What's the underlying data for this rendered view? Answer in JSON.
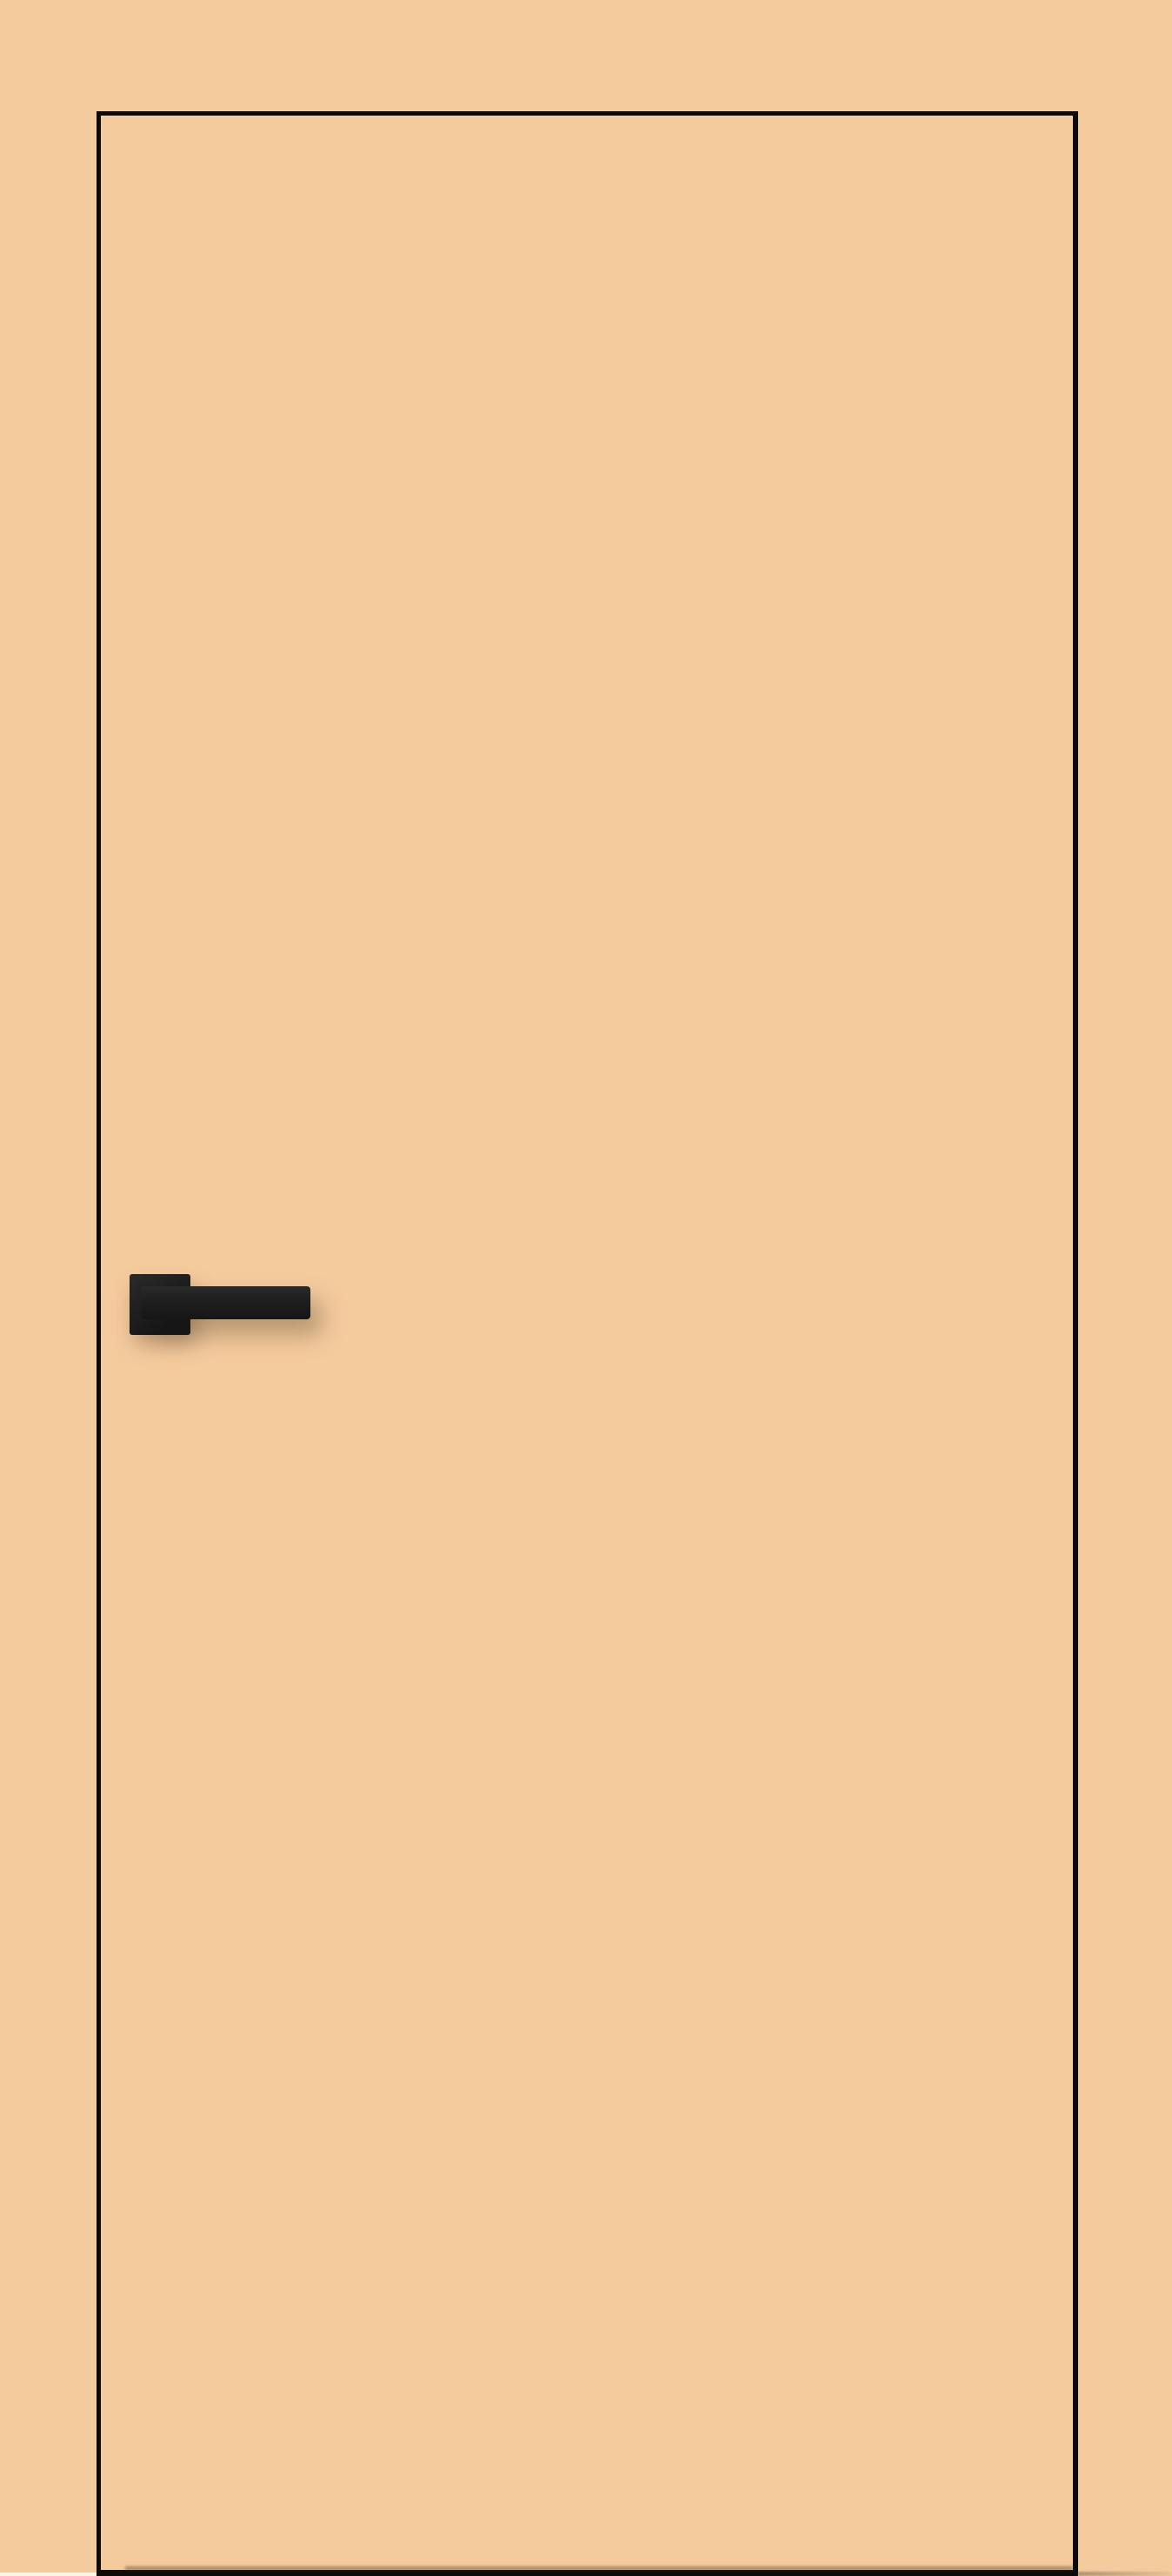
{
  "image": {
    "subject": "closed flush interior door, front view",
    "door_finish": "peach painted flush door leaf with thin black edge trim",
    "hardware": "matte black square-rosette lever handle mounted on the left side",
    "background": "plain peach wall matching the door face",
    "floor_detail": "dark floor line at the bottom edge with a faint shadow extending right"
  },
  "colors": {
    "background": "#F4CB9D",
    "door_face": "#F4CB9D",
    "door_edge": "#0D0B09",
    "handle_light": "#2A2A2B",
    "handle_dark": "#161617",
    "handle_shadow": "rgba(94,70,48,0.38)",
    "floor_shadow": "rgba(122,100,78,0.55)",
    "floor_sliver": "#FBF4E9"
  }
}
